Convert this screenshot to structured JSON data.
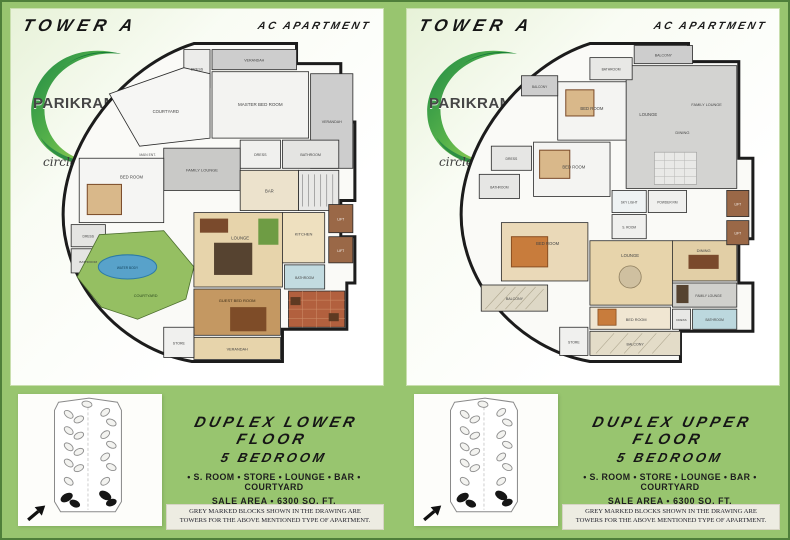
{
  "colors": {
    "page_green": "#98c56f",
    "page_border_green": "#4f7f3a",
    "panel_background": "#f9fcf4",
    "logo_green_dark": "#1f8a45",
    "logo_green_light": "#b9dc5a",
    "courtyard_green": "#95bf62",
    "pool_blue": "#58a2ca",
    "terrace_red": "#b2603e",
    "wall_black": "#1c1c1c",
    "lift_brown": "#9a6847"
  },
  "panels": [
    {
      "tower_label": "TOWER A",
      "apartment_type": "AC APARTMENT",
      "logo": {
        "brand": "PARIKRAMA",
        "tagline": "circle of life"
      },
      "title_line1": "DUPLEX LOWER FLOOR",
      "title_line2": "5 BEDROOM",
      "features": "• S. ROOM • STORE • LOUNGE • BAR • COURTYARD",
      "sale_area": "SALE AREA • 6300 SQ. FT.",
      "disclaimer": "GREY MARKED BLOCKS SHOWN IN THE DRAWING ARE TOWERS FOR THE ABOVE MENTIONED TYPE OF APARTMENT.",
      "rooms": [
        {
          "label": "DRESS"
        },
        {
          "label": "VERANDAH"
        },
        {
          "label": "MASTER BED ROOM"
        },
        {
          "label": "VERANDAH"
        },
        {
          "label": "DRESS"
        },
        {
          "label": "BATHROOM"
        },
        {
          "label": "COURTYARD"
        },
        {
          "label": "MAIN ENT."
        },
        {
          "label": "FAMILY LOUNGE"
        },
        {
          "label": "BED ROOM"
        },
        {
          "label": "BAR"
        },
        {
          "label": "DRESS"
        },
        {
          "label": "BATHROOM"
        },
        {
          "label": "WATER BODY"
        },
        {
          "label": "COURTYARD"
        },
        {
          "label": "LOUNGE"
        },
        {
          "label": "KITCHEN"
        },
        {
          "label": "LIFT"
        },
        {
          "label": "LIFT"
        },
        {
          "label": "GUEST BED ROOM"
        },
        {
          "label": "BATHROOM"
        },
        {
          "label": "STORE"
        },
        {
          "label": "VERANDAH"
        }
      ]
    },
    {
      "tower_label": "TOWER A",
      "apartment_type": "AC APARTMENT",
      "logo": {
        "brand": "PARIKRAMA",
        "tagline": "circle of life"
      },
      "title_line1": "DUPLEX UPPER FLOOR",
      "title_line2": "5 BEDROOM",
      "features": "• S. ROOM • STORE • LOUNGE • BAR • COURTYARD",
      "sale_area": "SALE AREA • 6300 SQ. FT.",
      "disclaimer": "GREY MARKED BLOCKS SHOWN IN THE DRAWING ARE TOWERS FOR THE ABOVE MENTIONED TYPE OF APARTMENT.",
      "rooms": [
        {
          "label": "BALCONY"
        },
        {
          "label": "BATHROOM"
        },
        {
          "label": "BED ROOM"
        },
        {
          "label": "BALCONY"
        },
        {
          "label": "LOUNGE"
        },
        {
          "label": "DINING"
        },
        {
          "label": "FAMILY LOUNGE"
        },
        {
          "label": "DRESS"
        },
        {
          "label": "BED ROOM"
        },
        {
          "label": "BATHROOM"
        },
        {
          "label": "SKY LIGHT"
        },
        {
          "label": "POWDER RM"
        },
        {
          "label": "S. ROOM"
        },
        {
          "label": "BED ROOM"
        },
        {
          "label": "BALCONY"
        },
        {
          "label": "LOUNGE"
        },
        {
          "label": "DINING"
        },
        {
          "label": "FAMILY LOUNGE"
        },
        {
          "label": "BED ROOM"
        },
        {
          "label": "BATHROOM"
        },
        {
          "label": "DRESS"
        },
        {
          "label": "BALCONY"
        },
        {
          "label": "STORE"
        },
        {
          "label": "LIFT"
        },
        {
          "label": "LIFT"
        }
      ]
    }
  ]
}
